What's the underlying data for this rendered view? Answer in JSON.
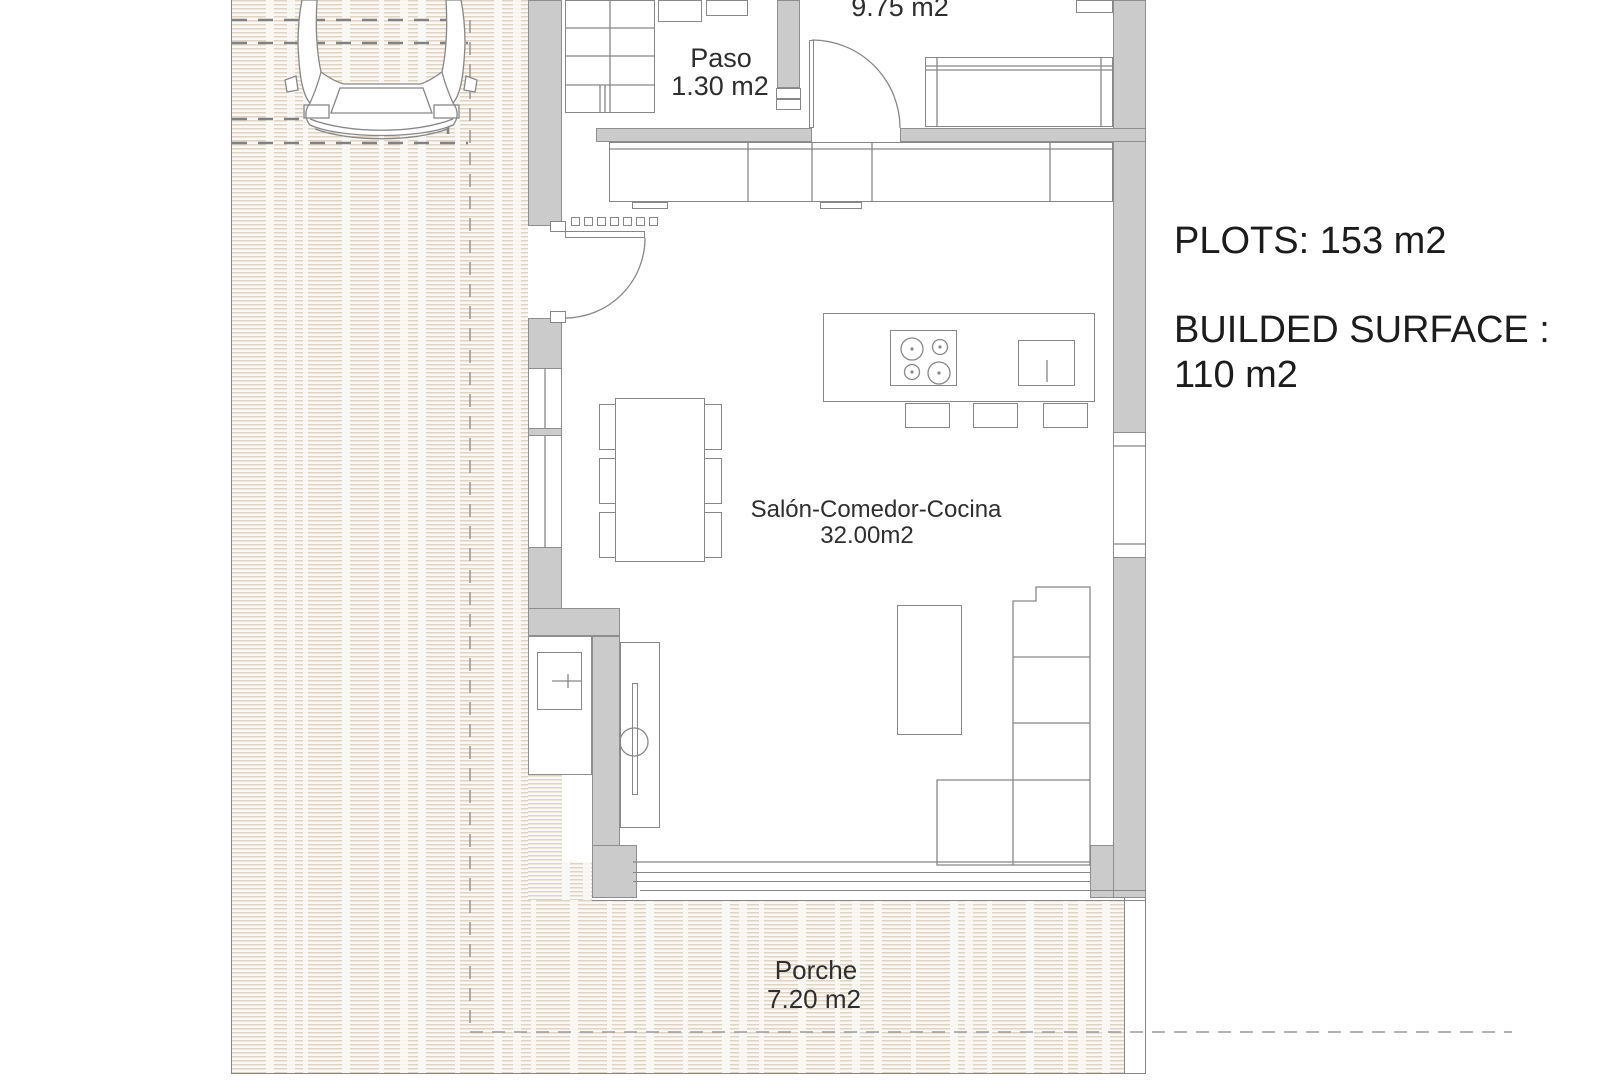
{
  "plan": {
    "rooms": {
      "bedroom": {
        "area": "9.75 m2"
      },
      "paso": {
        "name": "Paso",
        "area": "1.30 m2"
      },
      "salon": {
        "name": "Salón-Comedor-Cocina",
        "area": "32.00m2"
      },
      "porche": {
        "name": "Porche",
        "area": "7.20 m2"
      }
    }
  },
  "summary": {
    "plots": "PLOTS: 153 m2",
    "builded_surface_line1": "BUILDED SURFACE :",
    "builded_surface_line2": "110 m2"
  },
  "icons": {
    "car": "car-top-view-icon",
    "cooktop": "cooktop-4-burners-icon",
    "sink": "kitchen-sink-icon",
    "door_arcs": "door-swing-arc-icon"
  },
  "colors": {
    "wall": "#cbcbcb",
    "wall_outline": "#8e8e8e",
    "line": "#878787",
    "dash": "#9a9a9a",
    "dash2": "#828282",
    "hatch_line": "#ded4c6",
    "hatch_bg": "#faf8f4",
    "text": "#2e2e2e",
    "annotation_text": "#1c1c1c"
  }
}
